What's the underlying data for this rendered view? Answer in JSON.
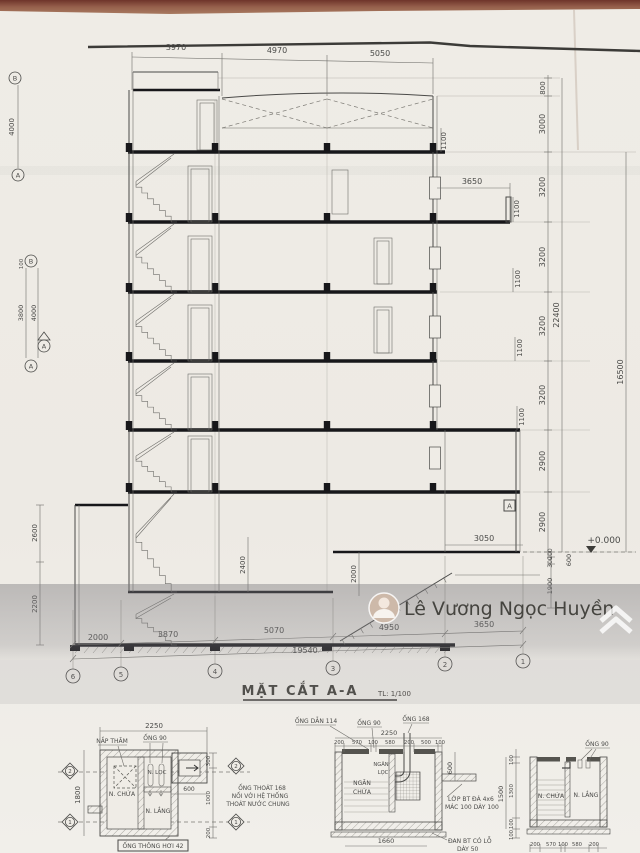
{
  "page": {
    "title": "MẶT CẮT A-A",
    "scale": "TL: 1/100"
  },
  "watermark": {
    "name": "Lê Vương Ngọc Huyền",
    "logo": "chevron-logo"
  },
  "main": {
    "top_dims": [
      "3970",
      "4970",
      "5050"
    ],
    "bottom_dims": [
      "2000",
      "3870",
      "5070",
      "4950",
      "3650"
    ],
    "bottom_total": "19540",
    "grid_bottom": [
      "6",
      "5",
      "4",
      "3",
      "2",
      "1"
    ],
    "right_chain": [
      "800",
      "3000",
      "3200",
      "3200",
      "3200",
      "3200",
      "2900",
      "2900"
    ],
    "right_outer": [
      "22400",
      "16500"
    ],
    "right_lower": [
      "200",
      "300",
      "1900",
      "600"
    ],
    "parapet_dims": [
      "1100",
      "1100",
      "1100",
      "1100",
      "1100"
    ],
    "dim_3650": "3650",
    "dim_3050": "3050",
    "level": "+0.000",
    "dim_2400": "2400",
    "dim_2000": "2000",
    "dim_2600": "2600",
    "dim_2200": "2200",
    "left_4000a": "4000",
    "left_4000b": "4000",
    "left_3800": "3800",
    "left_100a": "100",
    "grid_left": [
      "B",
      "A",
      "B",
      "A"
    ],
    "marker_a": "A",
    "marker_a2": "A"
  },
  "detail_plan": {
    "d2250": "2250",
    "nap_tham": "NẮP THĂM",
    "ong90": "ỐNG 90",
    "n_chua": "N. CHỨA",
    "n_loc": "N. LỌC",
    "n_lang": "N. LẮNG",
    "d600": "600",
    "d1800": "1800",
    "vent": "ỐNG THÔNG HƠI 42",
    "chain": [
      "300",
      "1000",
      "200"
    ],
    "diamonds": [
      "2",
      "1",
      "2",
      "1"
    ],
    "note_drain": [
      "ỐNG THOÁT 168",
      "NỐI VỚI HỆ THỐNG",
      "THOÁT NƯỚC CHUNG"
    ],
    "ong_dan": "ỐNG DẪN 114"
  },
  "detail_sec1": {
    "d2250": "2250",
    "ong90": "ỐNG 90",
    "ong168": "ỐNG 168",
    "sub_dims": [
      "200",
      "570",
      "100",
      "580",
      "200",
      "500",
      "100"
    ],
    "ngan_chua": [
      "NGĂN",
      "CHỨA"
    ],
    "ngan_loc": [
      "NGĂN",
      "LỌC"
    ],
    "d600": "600",
    "d1660": "1660",
    "note_bt": [
      "LỚP BT ĐÁ 4x6",
      "MÁC 100 DÀY 100"
    ],
    "note_dan": [
      "ĐAN BT CÓ LỖ",
      "DÀY 50"
    ]
  },
  "detail_sec2": {
    "ong90": "ỐNG 90",
    "n_chua": "N. CHỨA",
    "n_lang": "N. LẮNG",
    "left_chain": [
      "100",
      "1500",
      "1300",
      "100",
      "100"
    ],
    "bottom_dims": [
      "200",
      "570",
      "100",
      "580",
      "200"
    ]
  }
}
